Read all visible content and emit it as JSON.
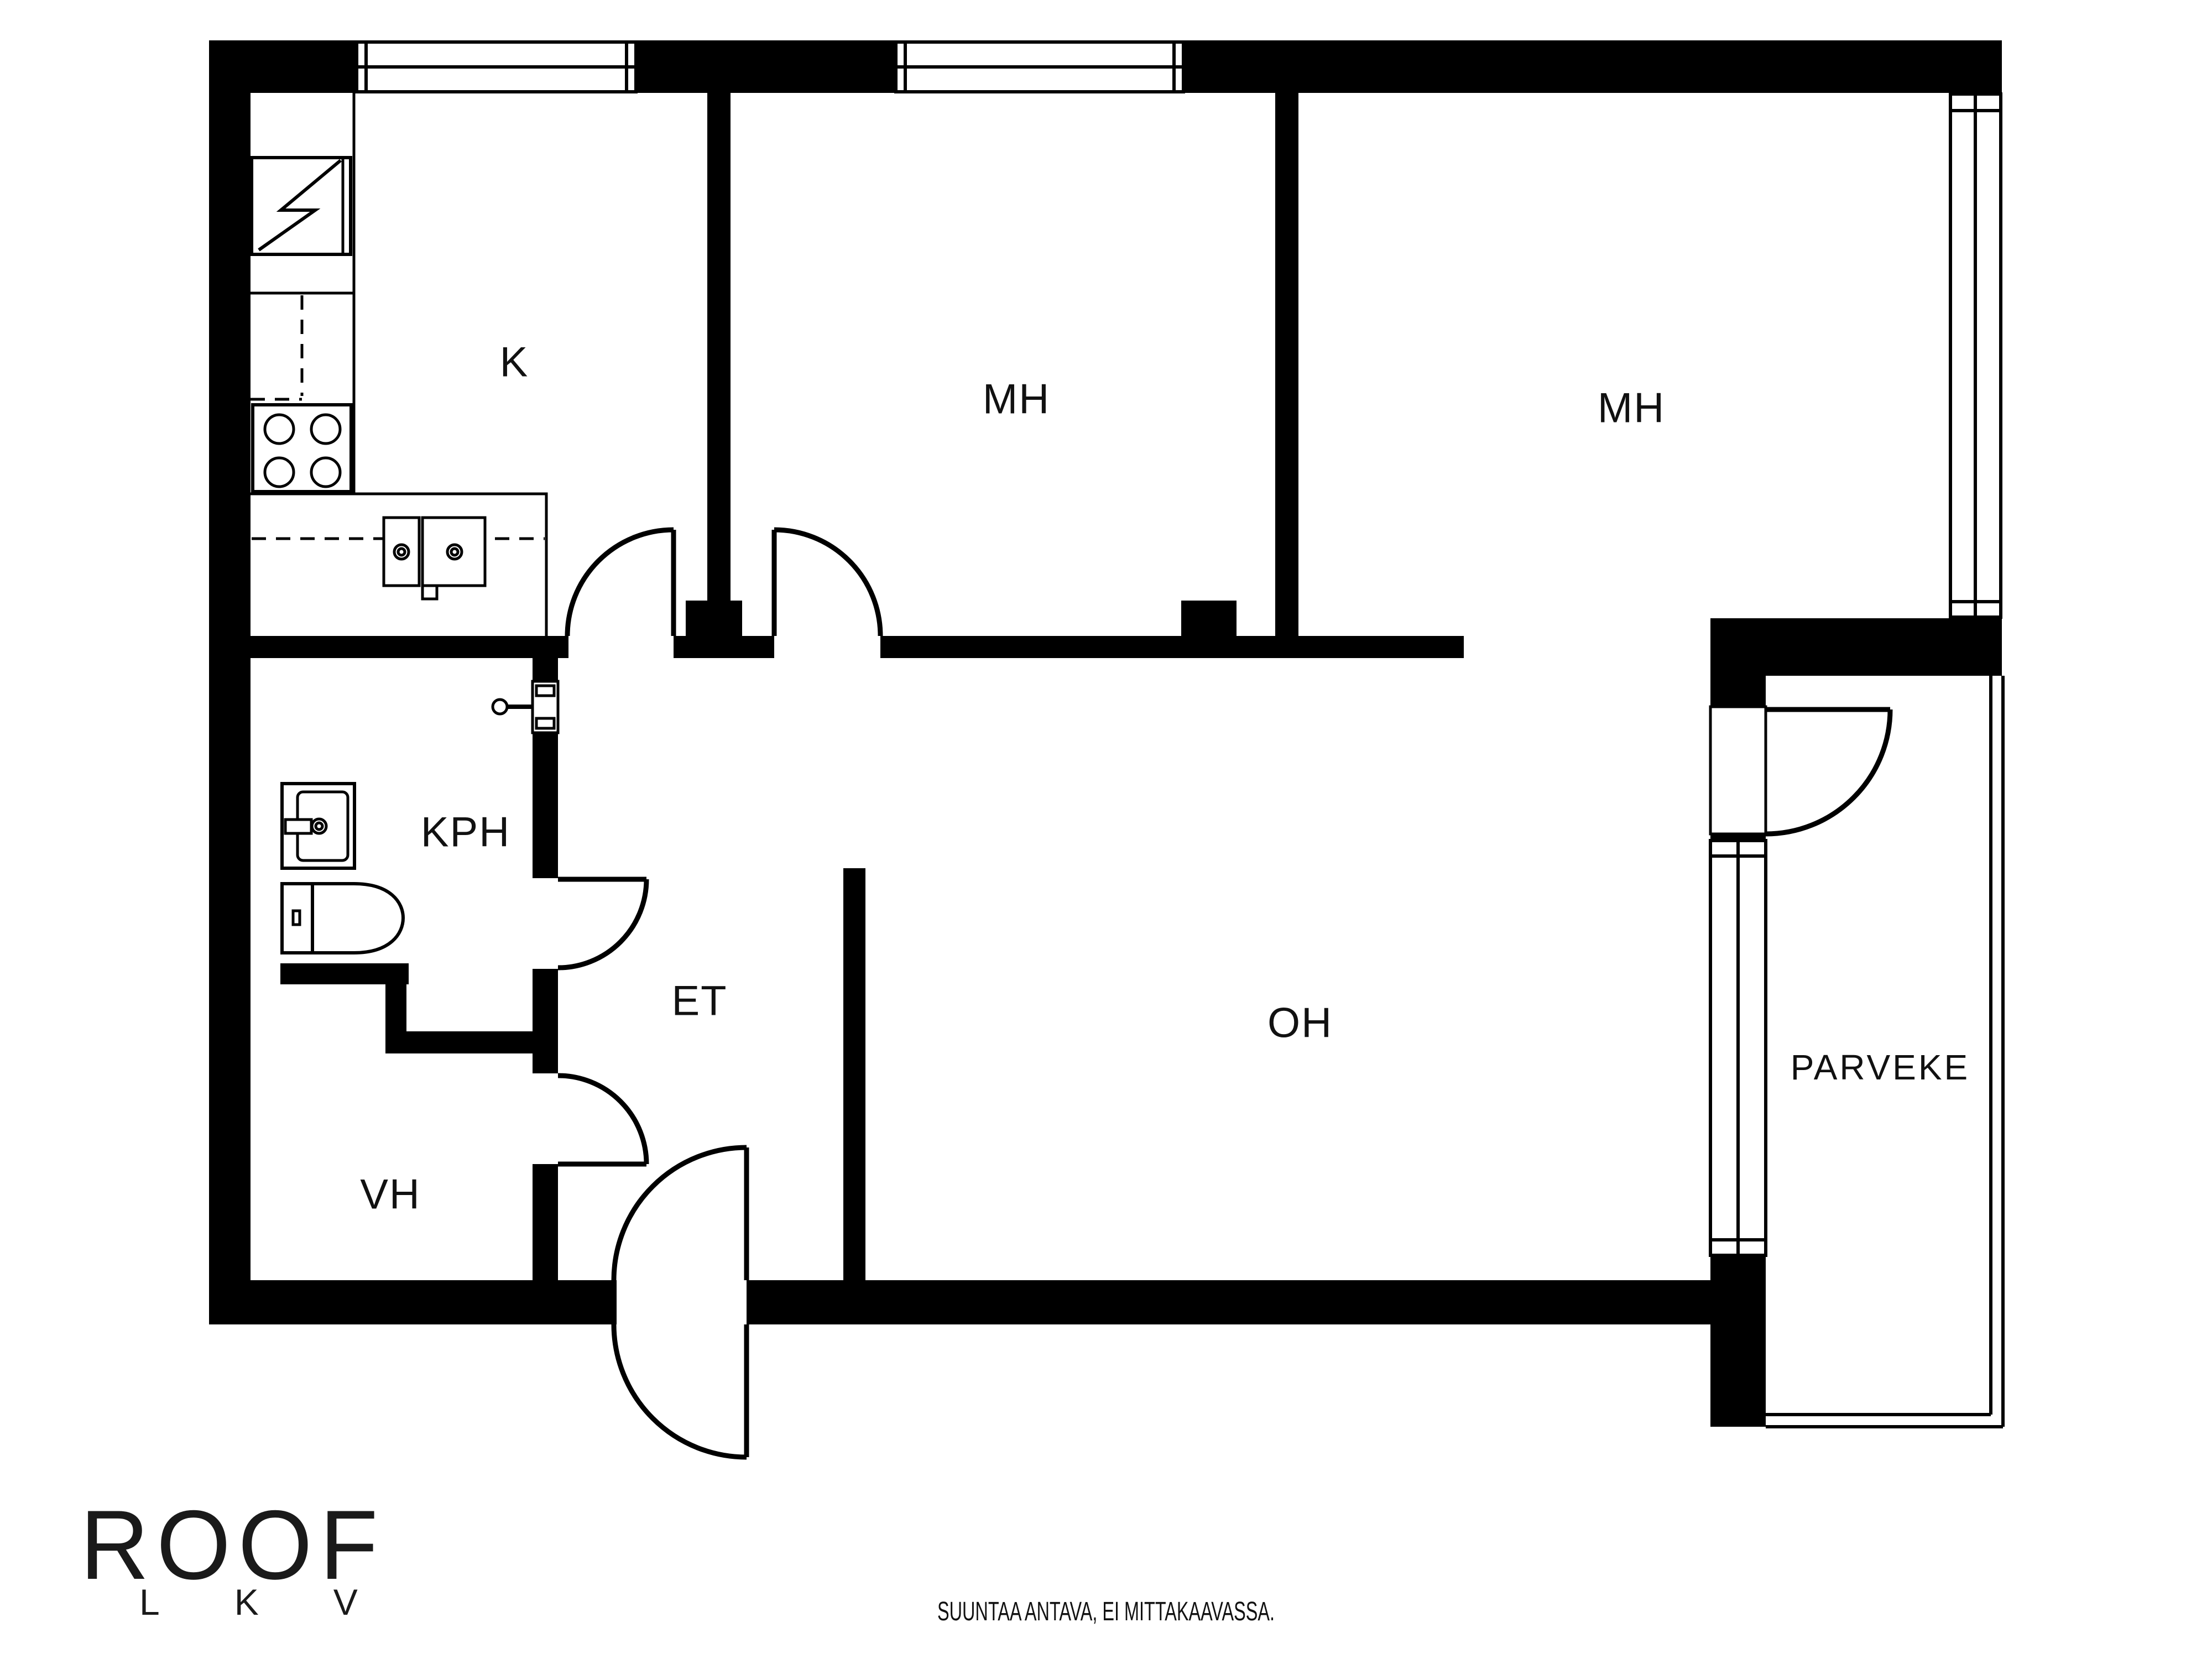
{
  "page": {
    "background": "#ffffff"
  },
  "colors": {
    "wall": "#000000",
    "line": "#000000",
    "text": "#111111"
  },
  "floor_plan": {
    "rooms": [
      {
        "id": "kitchen",
        "label": "K"
      },
      {
        "id": "bedroom-1",
        "label": "MH"
      },
      {
        "id": "bedroom-2",
        "label": "MH"
      },
      {
        "id": "bathroom",
        "label": "KPH"
      },
      {
        "id": "entrance",
        "label": "ET"
      },
      {
        "id": "living-room",
        "label": "OH"
      },
      {
        "id": "closet",
        "label": "VH"
      },
      {
        "id": "balcony",
        "label": "PARVEKE"
      }
    ],
    "fixtures": [
      "fridge-icon",
      "stove-icon",
      "kitchen-sink-icon",
      "washbasin-icon",
      "toilet-icon",
      "shower-mixer-icon",
      "door-swing-icon",
      "window-icon"
    ]
  },
  "logo": {
    "brand": "ROOF",
    "sub": "LKV"
  },
  "footer": {
    "disclaimer": "SUUNTAA ANTAVA, EI MITTAKAAVASSA."
  }
}
